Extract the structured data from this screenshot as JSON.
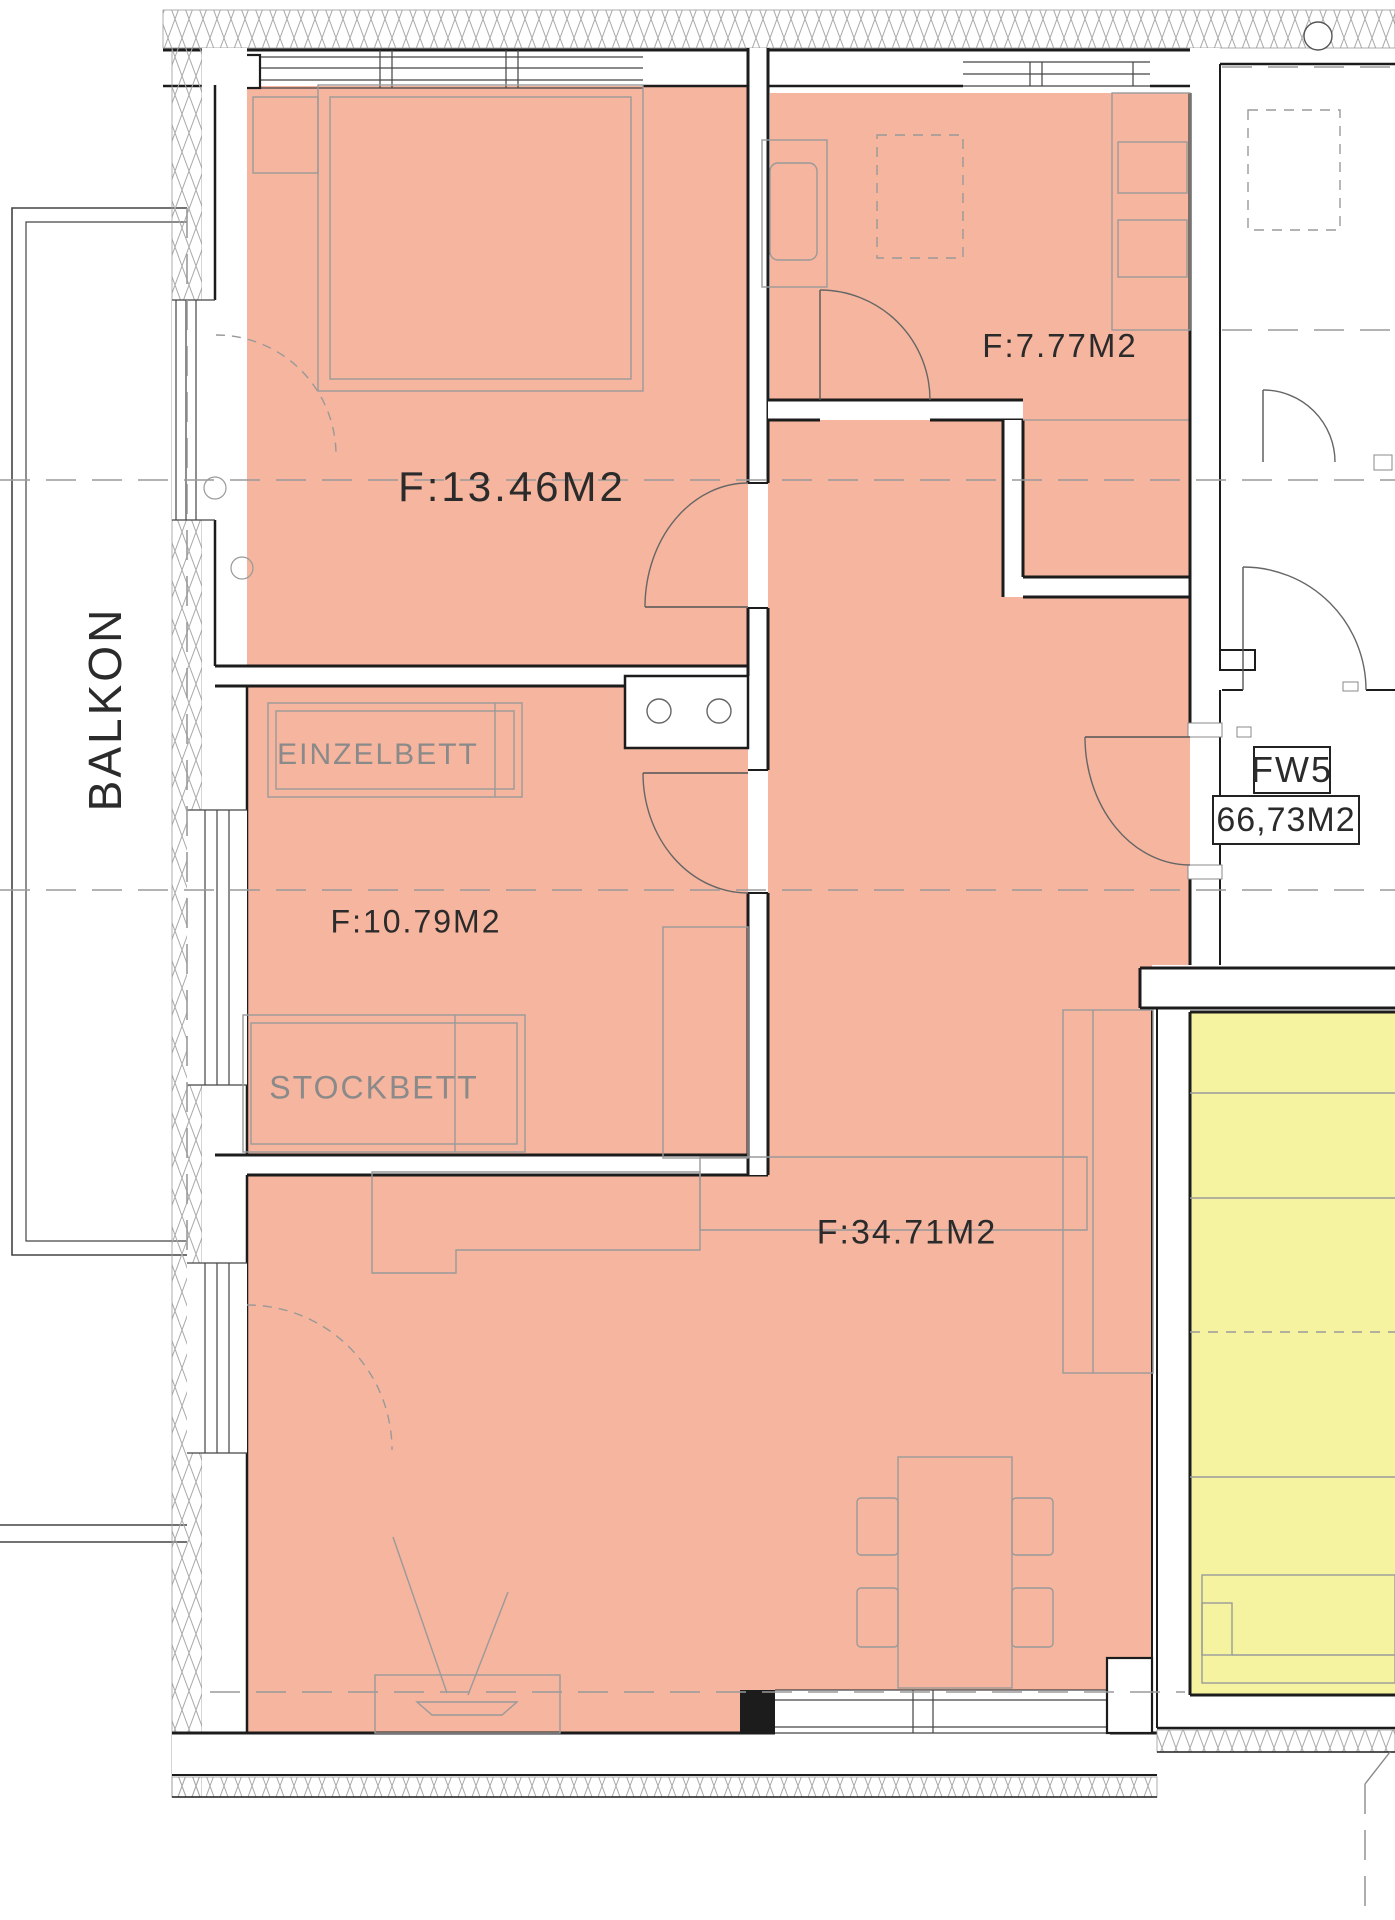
{
  "labels": {
    "balkon": "BALKON",
    "bedroom_area": "F:13.46M2",
    "kitchen_area": "F:7.77M2",
    "single_bed": "EINZELBETT",
    "kids_area": "F:10.79M2",
    "bunk_bed": "STOCKBETT",
    "living_area": "F:34.71M2",
    "unit_id": "FW5",
    "unit_area": "66,73M2"
  },
  "rooms": [
    {
      "name": "bedroom",
      "area_label": "F:13.46M2"
    },
    {
      "name": "kids-room",
      "area_label": "F:10.79M2",
      "furniture": [
        "EINZELBETT",
        "STOCKBETT"
      ]
    },
    {
      "name": "kitchen",
      "area_label": "F:7.77M2"
    },
    {
      "name": "living-room",
      "area_label": "F:34.71M2"
    },
    {
      "name": "balcony",
      "label": "BALKON"
    }
  ],
  "unit_badge": {
    "id": "FW5",
    "total_area": "66,73M2"
  },
  "colors": {
    "room_fill": "#f5b59e",
    "stair_fill": "#f6f3a0",
    "wall_line": "#1c1c1c",
    "furniture_line": "#9a9a9a",
    "dash_line": "#9a9a9a",
    "label_dark": "#2b2b2b",
    "label_gray": "#8a8a8a"
  }
}
